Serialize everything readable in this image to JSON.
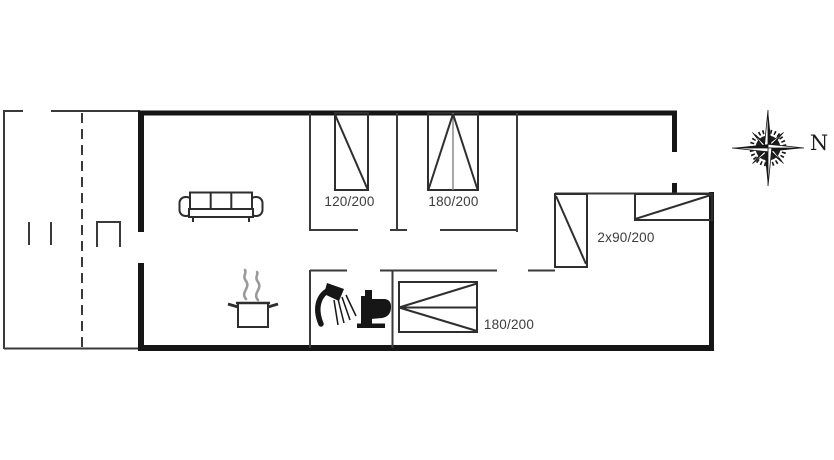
{
  "page": {
    "type": "vacation-home-floor-plan"
  },
  "colors": {
    "background": "#ffffff",
    "exterior_wall": "#161616",
    "interior_line": "#3a3a3a",
    "label_text": "#3d3d3d",
    "steam_gray": "#9a9a9a"
  },
  "beds": [
    {
      "id": "bedroom-top-left-bed",
      "size_label": "120/200"
    },
    {
      "id": "bedroom-top-middle-bed",
      "size_label": "180/200"
    },
    {
      "id": "bedroom-bottom-bed",
      "size_label": "180/200"
    },
    {
      "id": "bedroom-right-twin-beds",
      "size_label": "2x90/200"
    }
  ],
  "compass": {
    "north_label": "N"
  },
  "icons": {
    "sofa": "sofa-icon",
    "cooking_pot": "cooking-pot-icon",
    "steam": "steam-icon",
    "shower": "shower-icon",
    "toilet": "toilet-icon",
    "compass": "compass-rose-icon"
  }
}
